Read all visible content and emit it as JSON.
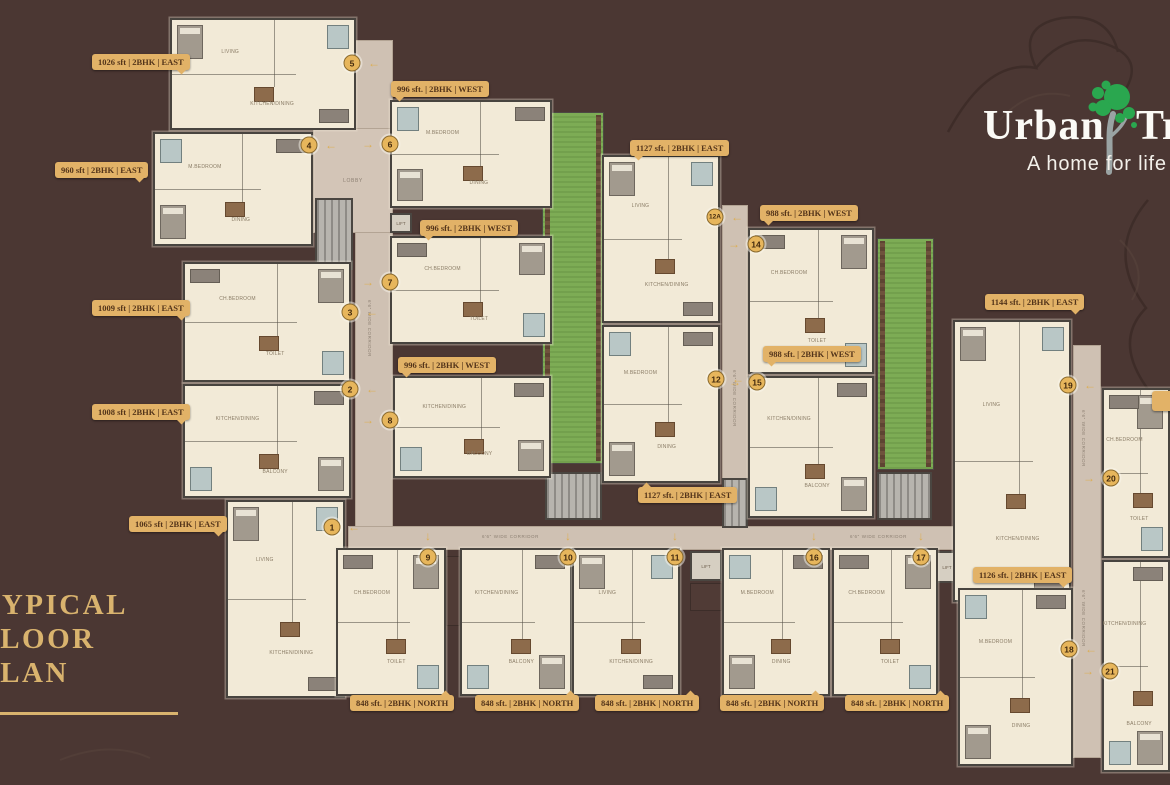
{
  "colors": {
    "background": "#4b3733",
    "accent_gold": "#e2b267",
    "heading_gold": "#d9b36e",
    "plan_cream": "#f2ead7",
    "garden_green": "#7dac55",
    "tree_green": "#2aa74f"
  },
  "logo": {
    "brand_left": "Urban",
    "brand_right": "Tree",
    "tagline": "A home for life"
  },
  "heading": {
    "line1": "TYPICAL",
    "line2": "FLOOR",
    "line3": "PLAN"
  },
  "strings": {
    "corridor": "6'6\" WIDE CORRIDOR",
    "lobby": "LOBBY",
    "lift": "LIFT"
  },
  "unit_labels": [
    {
      "text": "1026 sft | 2BHK | EAST",
      "x": 92,
      "y": 54,
      "tail": "br"
    },
    {
      "text": "960 sft | 2BHK | EAST",
      "x": 55,
      "y": 162,
      "tail": "br"
    },
    {
      "text": "1009 sft | 2BHK | EAST",
      "x": 92,
      "y": 300,
      "tail": "br"
    },
    {
      "text": "1008 sft | 2BHK | EAST",
      "x": 92,
      "y": 404,
      "tail": "br"
    },
    {
      "text": "1065 sft | 2BHK | EAST",
      "x": 129,
      "y": 516,
      "tail": "br"
    },
    {
      "text": "996 sft. | 2BHK | WEST",
      "x": 391,
      "y": 81,
      "tail": "bl"
    },
    {
      "text": "996 sft. | 2BHK | WEST",
      "x": 420,
      "y": 220,
      "tail": "bl"
    },
    {
      "text": "996 sft. | 2BHK | WEST",
      "x": 398,
      "y": 357,
      "tail": "bl"
    },
    {
      "text": "1127 sft. | 2BHK | EAST",
      "x": 630,
      "y": 140,
      "tail": "bl"
    },
    {
      "text": "1127 sft. | 2BHK | EAST",
      "x": 638,
      "y": 487,
      "tail": "tl"
    },
    {
      "text": "988 sft. | 2BHK | WEST",
      "x": 760,
      "y": 205,
      "tail": "bl"
    },
    {
      "text": "988 sft. | 2BHK | WEST",
      "x": 763,
      "y": 346,
      "tail": "bl"
    },
    {
      "text": "1144 sft. | 2BHK | EAST",
      "x": 985,
      "y": 294,
      "tail": "br"
    },
    {
      "text": "1126 sft. | 2BHK | EAST",
      "x": 973,
      "y": 567,
      "tail": "br"
    },
    {
      "text": "848 sft. | 2BHK | NORTH",
      "x": 350,
      "y": 695,
      "tail": "tr"
    },
    {
      "text": "848 sft. | 2BHK | NORTH",
      "x": 475,
      "y": 695,
      "tail": "tr"
    },
    {
      "text": "848 sft. | 2BHK | NORTH",
      "x": 595,
      "y": 695,
      "tail": "tr"
    },
    {
      "text": "848 sft. | 2BHK | NORTH",
      "x": 720,
      "y": 695,
      "tail": "tr"
    },
    {
      "text": "848 sft. | 2BHK | NORTH",
      "x": 845,
      "y": 695,
      "tail": "tr"
    },
    {
      "text": "",
      "x": 1152,
      "y": 391,
      "tail": "none"
    }
  ],
  "markers": [
    {
      "n": "1",
      "x": 332,
      "y": 527,
      "a": "left"
    },
    {
      "n": "2",
      "x": 350,
      "y": 389,
      "a": "left"
    },
    {
      "n": "3",
      "x": 350,
      "y": 312,
      "a": "left"
    },
    {
      "n": "4",
      "x": 309,
      "y": 145,
      "a": "left"
    },
    {
      "n": "5",
      "x": 352,
      "y": 63,
      "a": "left"
    },
    {
      "n": "6",
      "x": 390,
      "y": 144,
      "a": "right"
    },
    {
      "n": "7",
      "x": 390,
      "y": 282,
      "a": "right"
    },
    {
      "n": "8",
      "x": 390,
      "y": 420,
      "a": "right"
    },
    {
      "n": "9",
      "x": 428,
      "y": 557,
      "a": "down"
    },
    {
      "n": "10",
      "x": 568,
      "y": 557,
      "a": "down"
    },
    {
      "n": "11",
      "x": 675,
      "y": 557,
      "a": "down"
    },
    {
      "n": "12",
      "x": 716,
      "y": 379,
      "a": "left"
    },
    {
      "n": "12A",
      "x": 715,
      "y": 217,
      "a": "left"
    },
    {
      "n": "14",
      "x": 756,
      "y": 244,
      "a": "right"
    },
    {
      "n": "15",
      "x": 757,
      "y": 382,
      "a": "right"
    },
    {
      "n": "16",
      "x": 814,
      "y": 557,
      "a": "down"
    },
    {
      "n": "17",
      "x": 921,
      "y": 557,
      "a": "down"
    },
    {
      "n": "18",
      "x": 1069,
      "y": 649,
      "a": "left"
    },
    {
      "n": "19",
      "x": 1068,
      "y": 385,
      "a": "left"
    },
    {
      "n": "20",
      "x": 1111,
      "y": 478,
      "a": "right"
    },
    {
      "n": "21",
      "x": 1110,
      "y": 671,
      "a": "right"
    }
  ],
  "plan": {
    "room_names": [
      "LIVING",
      "M.BEDROOM",
      "CH.BEDROOM",
      "KITCHEN/DINING",
      "DINING",
      "TOILET",
      "BALCONY"
    ],
    "blocks": [
      {
        "x": 170,
        "y": 18,
        "w": 186,
        "h": 112,
        "v": 0
      },
      {
        "x": 153,
        "y": 132,
        "w": 160,
        "h": 114,
        "v": 1
      },
      {
        "x": 183,
        "y": 262,
        "w": 168,
        "h": 120,
        "v": 2
      },
      {
        "x": 183,
        "y": 384,
        "w": 168,
        "h": 114,
        "v": 3
      },
      {
        "x": 226,
        "y": 500,
        "w": 119,
        "h": 198,
        "v": 0
      },
      {
        "x": 390,
        "y": 100,
        "w": 162,
        "h": 108,
        "v": 1
      },
      {
        "x": 390,
        "y": 236,
        "w": 162,
        "h": 108,
        "v": 2
      },
      {
        "x": 393,
        "y": 376,
        "w": 158,
        "h": 102,
        "v": 3
      },
      {
        "x": 602,
        "y": 155,
        "w": 118,
        "h": 168,
        "v": 0
      },
      {
        "x": 602,
        "y": 325,
        "w": 118,
        "h": 158,
        "v": 1
      },
      {
        "x": 748,
        "y": 228,
        "w": 126,
        "h": 146,
        "v": 2
      },
      {
        "x": 748,
        "y": 376,
        "w": 126,
        "h": 142,
        "v": 3
      },
      {
        "x": 953,
        "y": 320,
        "w": 118,
        "h": 282,
        "v": 0
      },
      {
        "x": 958,
        "y": 588,
        "w": 115,
        "h": 178,
        "v": 1
      },
      {
        "x": 1102,
        "y": 388,
        "w": 68,
        "h": 170,
        "v": 2
      },
      {
        "x": 1102,
        "y": 560,
        "w": 68,
        "h": 212,
        "v": 3
      },
      {
        "x": 336,
        "y": 548,
        "w": 110,
        "h": 148,
        "v": 2
      },
      {
        "x": 460,
        "y": 548,
        "w": 112,
        "h": 148,
        "v": 3
      },
      {
        "x": 572,
        "y": 548,
        "w": 108,
        "h": 148,
        "v": 0
      },
      {
        "x": 722,
        "y": 548,
        "w": 108,
        "h": 148,
        "v": 1
      },
      {
        "x": 832,
        "y": 548,
        "w": 106,
        "h": 148,
        "v": 2
      }
    ],
    "corridors": [
      {
        "x": 355,
        "y": 40,
        "w": 38,
        "h": 510
      },
      {
        "x": 722,
        "y": 205,
        "w": 26,
        "h": 345
      },
      {
        "x": 1073,
        "y": 345,
        "w": 28,
        "h": 413
      },
      {
        "x": 348,
        "y": 526,
        "w": 608,
        "h": 24
      }
    ],
    "corridor_texts": [
      {
        "x": 372,
        "y": 300,
        "rot": 90
      },
      {
        "x": 737,
        "y": 370,
        "rot": 90
      },
      {
        "x": 1086,
        "y": 410,
        "rot": 90
      },
      {
        "x": 1086,
        "y": 590,
        "rot": 90
      },
      {
        "x": 482,
        "y": 534,
        "rot": 0
      },
      {
        "x": 850,
        "y": 534,
        "rot": 0
      }
    ],
    "lobbies": [
      {
        "x": 313,
        "y": 128,
        "w": 80,
        "h": 105
      }
    ],
    "greens": [
      {
        "x": 542,
        "y": 112,
        "w": 62,
        "h": 352
      },
      {
        "x": 877,
        "y": 238,
        "w": 57,
        "h": 232
      }
    ],
    "stairs": [
      {
        "x": 315,
        "y": 198,
        "w": 38,
        "h": 72
      },
      {
        "x": 545,
        "y": 472,
        "w": 57,
        "h": 48
      },
      {
        "x": 877,
        "y": 472,
        "w": 55,
        "h": 48
      },
      {
        "x": 722,
        "y": 478,
        "w": 26,
        "h": 50
      }
    ],
    "lifts": [
      {
        "x": 390,
        "y": 213,
        "w": 22,
        "h": 20
      },
      {
        "x": 690,
        "y": 551,
        "w": 32,
        "h": 30
      },
      {
        "x": 936,
        "y": 551,
        "w": 22,
        "h": 32
      }
    ],
    "shafts": [
      {
        "x": 690,
        "y": 583,
        "w": 32,
        "h": 28
      },
      {
        "x": 446,
        "y": 556,
        "w": 14,
        "h": 70
      }
    ]
  }
}
